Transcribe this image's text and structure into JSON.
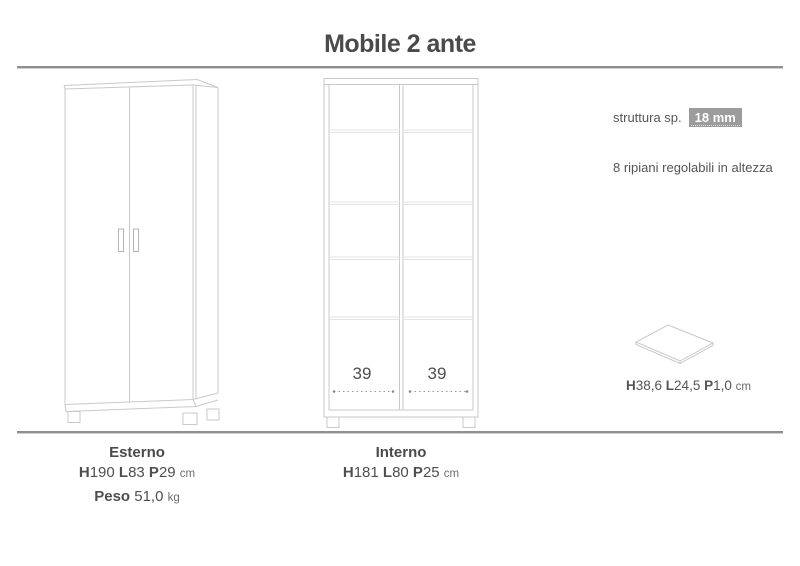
{
  "title": "Mobile 2 ante",
  "colors": {
    "text": "#4d4d4d",
    "drawing_line": "#c9c9c9",
    "shelf_line": "#e3e3e3",
    "badge_bg": "#9c9c9c",
    "badge_text": "#ffffff",
    "divider": "#8f8f8f"
  },
  "right_panel": {
    "structure_label": "struttura sp.",
    "structure_value": "18 mm",
    "shelves_note": "8 ripiani regolabili in altezza",
    "shelf_dims": {
      "h_label": "H",
      "h_value": "38,6",
      "l_label": "L",
      "l_value": "24,5",
      "p_label": "P",
      "p_value": "1,0",
      "unit": "cm"
    }
  },
  "interior_drawing": {
    "left_compartment_width": "39",
    "right_compartment_width": "39"
  },
  "footer": {
    "exterior": {
      "heading": "Esterno",
      "h_label": "H",
      "h_value": "190",
      "l_label": "L",
      "l_value": "83",
      "p_label": "P",
      "p_value": "29",
      "unit": "cm",
      "weight_label": "Peso",
      "weight_value": "51,0",
      "weight_unit": "kg"
    },
    "interior": {
      "heading": "Interno",
      "h_label": "H",
      "h_value": "181",
      "l_label": "L",
      "l_value": "80",
      "p_label": "P",
      "p_value": "25",
      "unit": "cm"
    }
  }
}
